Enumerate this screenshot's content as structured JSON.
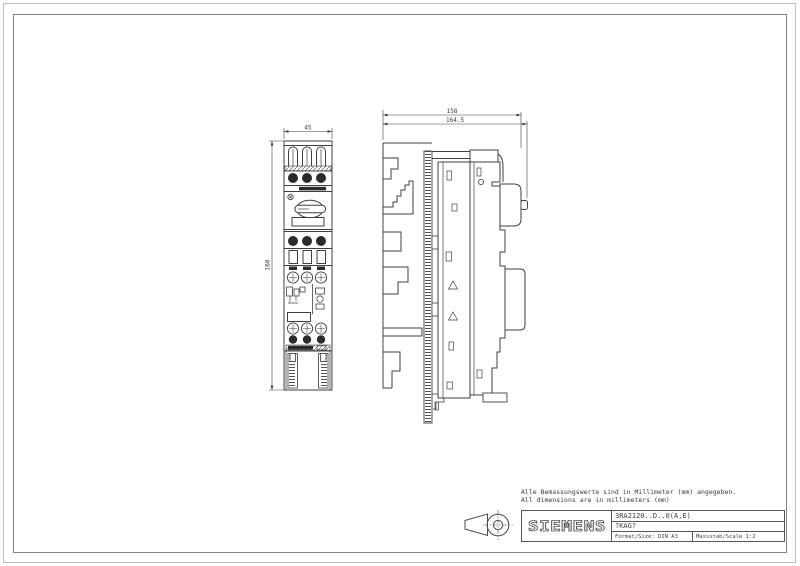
{
  "sheet": {
    "background": "#ffffff",
    "line_color": "#3f3f3f",
    "border_outer_color": "#bcbcbc",
    "border_inner_color": "#828282"
  },
  "notes": {
    "line_de": "Alle Bemassungswerte sind in Millimeter (mm) angegeben.",
    "line_en": "All dimensions are in millimeters (mm)"
  },
  "title_block": {
    "brand": "SIEMENS",
    "order_number": "3RA2120..D..0(A,E)",
    "reference": "?KAG?",
    "format": "Format/Size: DIN A3",
    "scale": "Massstab/Scale 1:2"
  },
  "dimensions": {
    "front_width": "45",
    "front_height": "160",
    "side_depth": "158",
    "side_depth_total": "164.5"
  },
  "icons": {
    "projection_symbol": "first-angle-projection"
  }
}
